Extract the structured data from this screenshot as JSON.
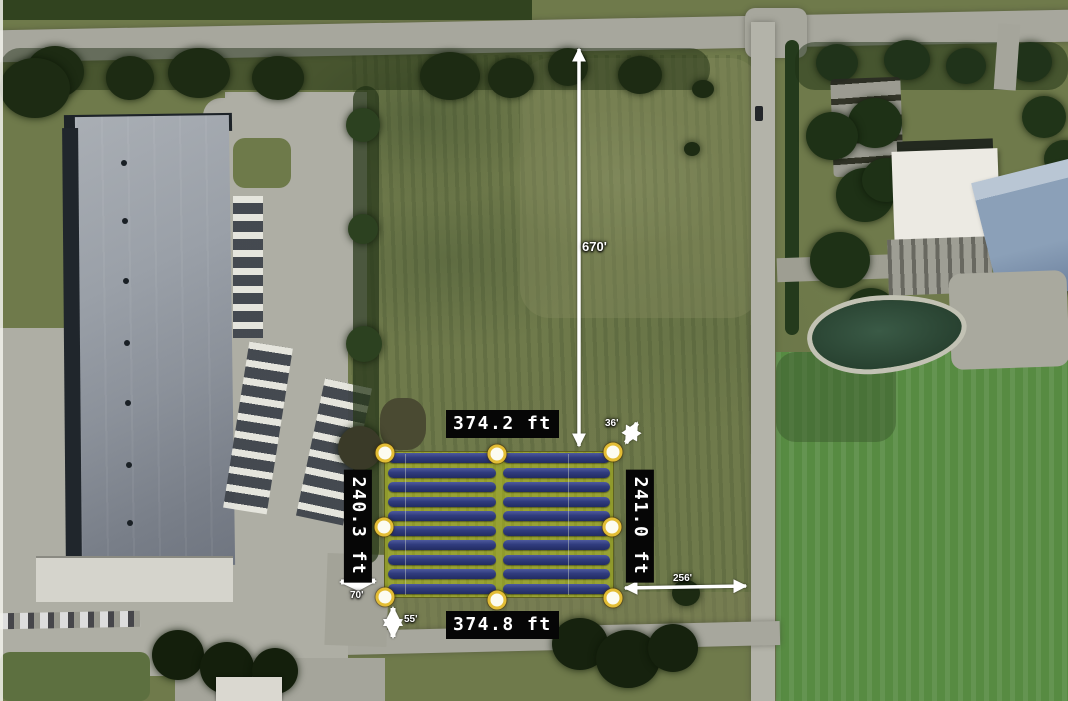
{
  "annotations": {
    "edge_measurements": {
      "top": "374.2 ft",
      "bottom": "374.8 ft",
      "left": "240.3 ft",
      "right": "241.0 ft"
    },
    "setback_distances": {
      "north": "670'",
      "northeast": "36'",
      "east": "256'",
      "west": "70'",
      "south": "55'"
    }
  },
  "solar_array": {
    "rows": 10,
    "columns": 2,
    "vertex_handles": 8
  },
  "icons": {
    "vertex_handle": "yellow-ring-circle-handle",
    "measurement_arrow": "white-double-headed-arrow"
  },
  "colors": {
    "panel_blue": "#303c7e",
    "array_ground_yellow": "#98a233",
    "handle_ring_gold": "#e3bd35",
    "label_background": "#060606",
    "label_text": "#ffffff",
    "arrow_white": "#ffffff"
  }
}
